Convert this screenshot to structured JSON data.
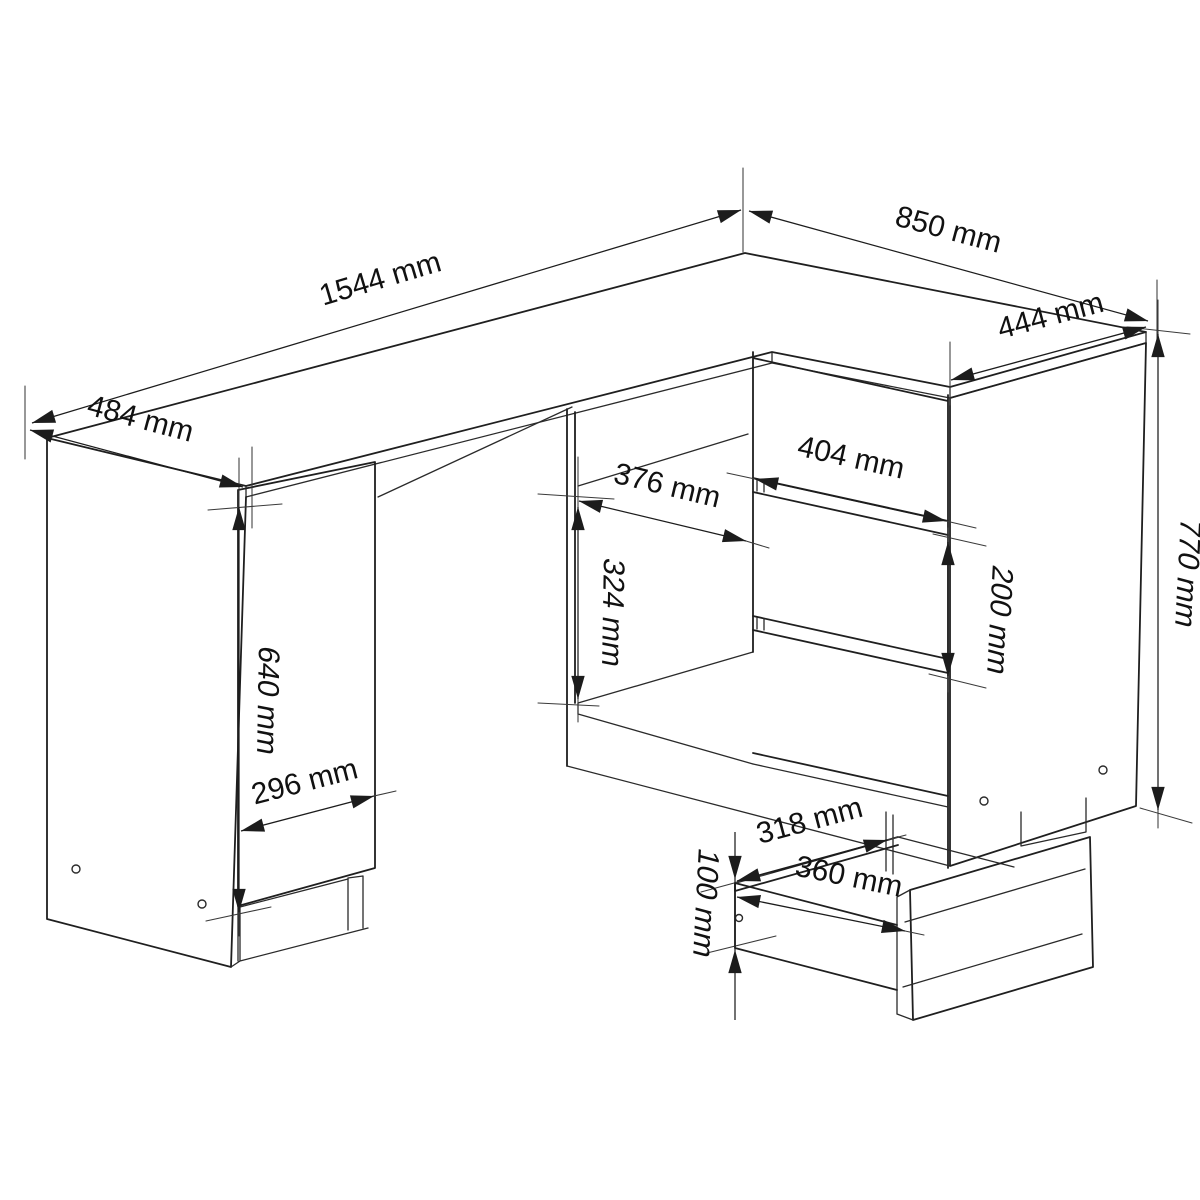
{
  "diagram": {
    "type": "furniture-technical-dimension-drawing",
    "subject": "L-shaped corner desk with left door cabinet, open compartments, three-drawer unit and pulled-out drawer box",
    "unit": "mm",
    "colors": {
      "background": "#ffffff",
      "line": "#1f1f1f",
      "text": "#111111"
    },
    "dims": {
      "desk_length": "1544 mm",
      "return_length": "850 mm",
      "return_front_width": "444 mm",
      "desk_depth": "484 mm",
      "door_height": "640 mm",
      "door_width": "296 mm",
      "compartment_height": "324 mm",
      "compartment_width": "376 mm",
      "drawer_front_width": "404 mm",
      "drawer_front_height": "200 mm",
      "desk_height": "770 mm",
      "drawer_inner_width": "318 mm",
      "drawer_inner_depth": "360 mm",
      "drawer_side_height": "100 mm"
    }
  }
}
